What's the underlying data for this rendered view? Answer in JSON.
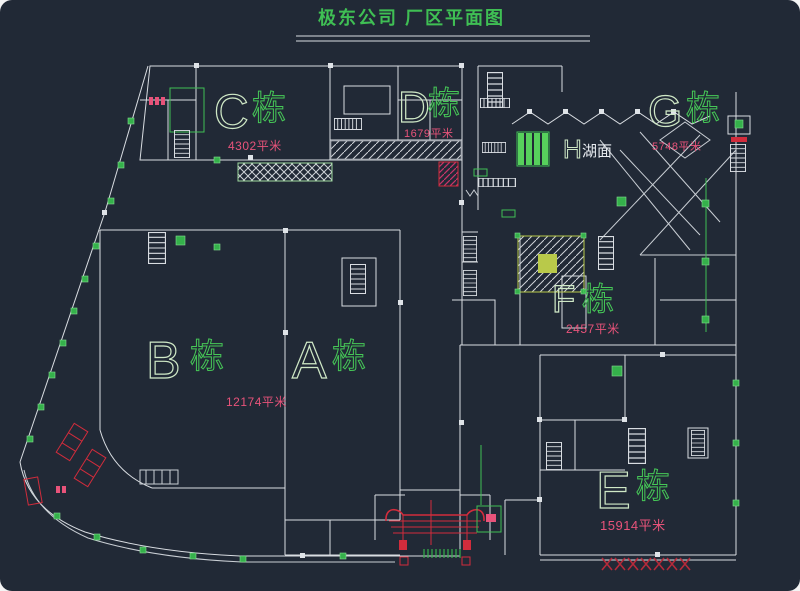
{
  "title": "极东公司  厂区平面图",
  "buildings": {
    "c": {
      "letter": "C",
      "suffix": "栋",
      "area": "4302平米"
    },
    "d": {
      "letter": "D",
      "suffix": "栋",
      "area": "1679平米"
    },
    "g": {
      "letter": "G",
      "suffix": "栋",
      "area": "5748平米"
    },
    "h": {
      "letter": "H",
      "suffix": "湖面"
    },
    "f": {
      "letter": "F",
      "suffix": "栋",
      "area": "2457平米"
    },
    "b": {
      "letter": "B",
      "suffix": "栋"
    },
    "a": {
      "letter": "A",
      "suffix": "栋"
    },
    "e": {
      "letter": "E",
      "suffix": "栋",
      "area": "15914平米"
    }
  },
  "ab_area": "12174平米",
  "colors": {
    "background": "#212936",
    "lines": "#d9dde2",
    "green": "#3fbf54",
    "letter_green": "#cfe8c6",
    "magenta": "#e8537a",
    "red": "#d22c3c"
  }
}
